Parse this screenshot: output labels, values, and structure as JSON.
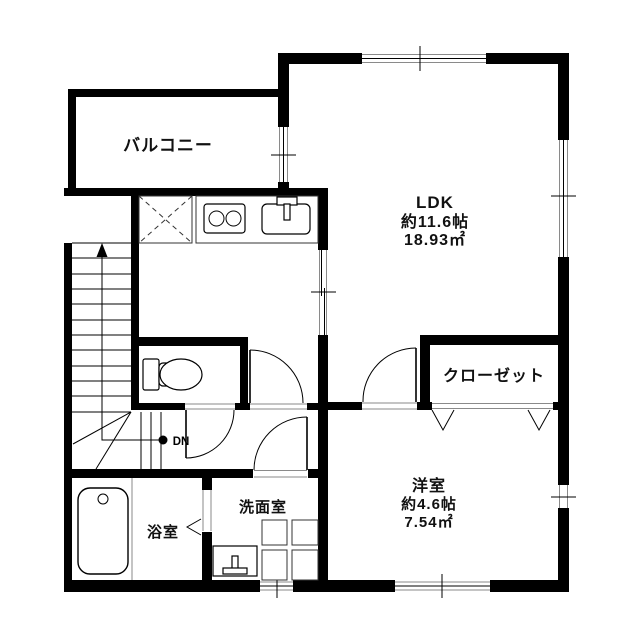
{
  "rooms": {
    "balcony": {
      "label": "バルコニー"
    },
    "ldk": {
      "label": "LDK",
      "size": "約11.6帖",
      "area": "18.93㎡"
    },
    "closet": {
      "label": "クローゼット"
    },
    "western_room": {
      "label": "洋室",
      "size": "約4.6帖",
      "area": "7.54㎡"
    },
    "washroom": {
      "label": "洗面室"
    },
    "bathroom": {
      "label": "浴室"
    }
  },
  "stairs": {
    "down_marker": "DN"
  },
  "colors": {
    "wall": "#000000",
    "background": "#ffffff",
    "accent_line": "#8a8a8a"
  }
}
